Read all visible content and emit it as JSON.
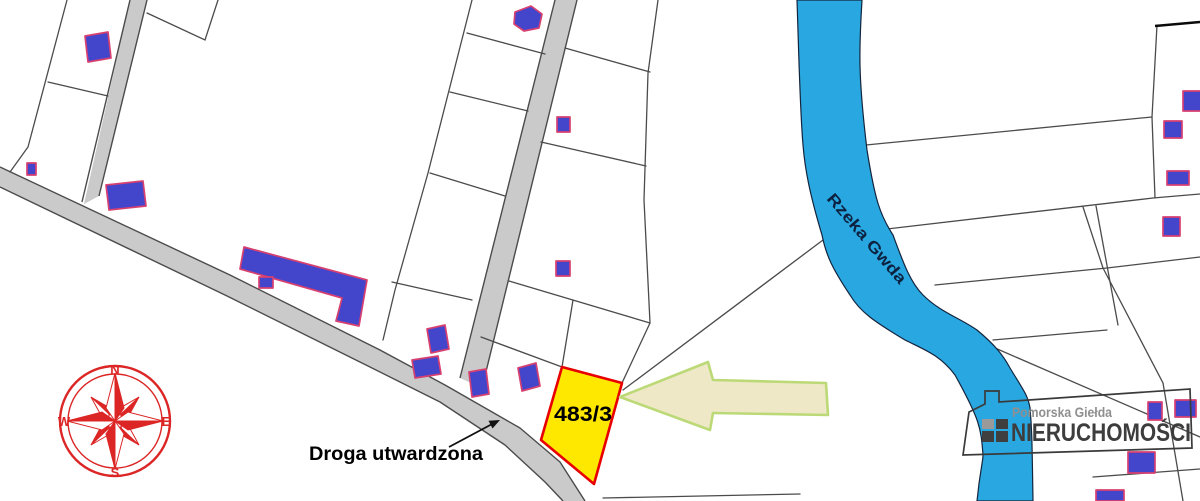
{
  "map": {
    "highlighted_parcel": {
      "label": "483/3"
    },
    "road_label": "Droga utwardzona",
    "river_label": "Rzeka Gwda",
    "compass": {
      "north": "N",
      "east": "E",
      "south": "S",
      "west": "W"
    },
    "watermark": {
      "line1": "Pomorska Giełda",
      "line2": "NIERUCHOMOŚCI"
    },
    "colors": {
      "highlight_parcel_fill": "#ffe800",
      "highlight_parcel_outline": "#e80000",
      "building_fill": "#4345cb",
      "building_outline": "#d84070",
      "river_fill": "#29a7e0",
      "road_fill": "#cacaca",
      "parcel_line": "#4b4b4b",
      "pointer_arrow_fill": "#efe8c6",
      "pointer_arrow_outline": "#bcd977",
      "compass_red": "#dc2626",
      "watermark_gray": "#3d3d3d"
    }
  }
}
